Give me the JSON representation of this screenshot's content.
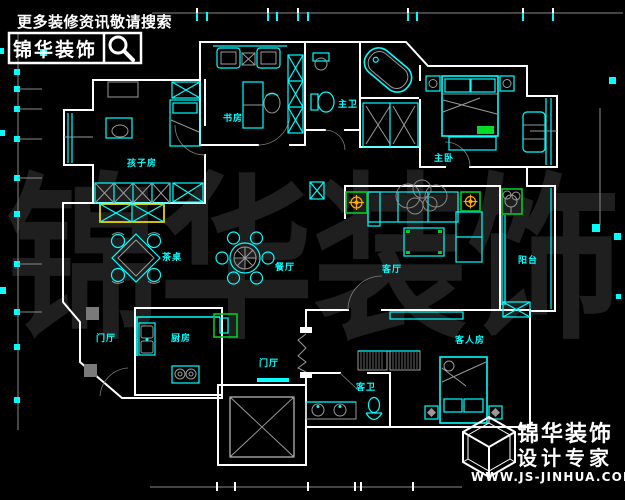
{
  "branding_top": {
    "tagline": "更多装修资讯敬请搜索",
    "logo_text": "锦华装饰",
    "search_icon": "magnifier-icon"
  },
  "watermark_text": "锦华装饰",
  "branding_bottom": {
    "company": "锦华装饰",
    "tagline": "设计专家",
    "website": "WWW.JS-JINHUA.COM",
    "logo_icon": "cube-wireframe-icon"
  },
  "floorplan": {
    "rooms": {
      "study": "书房",
      "master_bath": "主卫",
      "master_bedroom": "主卧",
      "kids_room": "孩子房",
      "tea_table": "茶桌",
      "dining": "餐厅",
      "living": "客厅",
      "balcony": "阳台",
      "foyer": "门厅",
      "kitchen": "厨房",
      "inner_hall": "门厅",
      "guest_bath": "客卫",
      "guest_room": "客人房"
    },
    "colors": {
      "background": "#000000",
      "wall": "#ffffff",
      "furniture": "#00ffff",
      "accent_green": "#00cc22",
      "accent_yellow": "#ffee00",
      "accent_orange": "#ffaa00",
      "dimension_gray": "#8a8a8a",
      "watermark_gray": "#1f1f1f"
    }
  }
}
